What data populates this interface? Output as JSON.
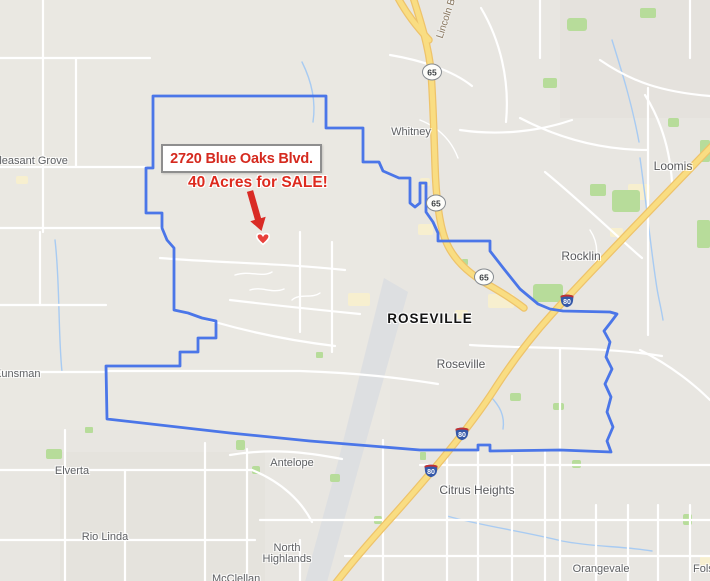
{
  "annotation": {
    "title": "2720 Blue Oaks Blvd.",
    "subtitle": "40 Acres for SALE!",
    "accent_color": "#d52a1f",
    "marker": "heart"
  },
  "map": {
    "labels": {
      "pleasant_grove": "Pleasant Grove",
      "whitney": "Whitney",
      "loomis": "Loomis",
      "rocklin": "Rocklin",
      "roseville_large": "ROSEVILLE",
      "roseville": "Roseville",
      "kunsman": "Kunsman",
      "antelope": "Antelope",
      "citrus_heights": "Citrus Heights",
      "north_highlands_line1": "North",
      "north_highlands_line2": "Highlands",
      "elverta": "Elverta",
      "rio_linda": "Rio Linda",
      "orangevale": "Orangevale",
      "mcclellan": "McClellan",
      "folsom": "Folsom",
      "lincoln_blvd": "Lincoln Bl"
    },
    "shields": {
      "hwy65": "65",
      "i80": "80"
    },
    "colors": {
      "boundary": "#4b76e8",
      "highway_fill": "#f9dd82",
      "highway_edge": "#eec36a",
      "park_green": "#b7dc9a",
      "land": "#e8e6e1"
    }
  }
}
